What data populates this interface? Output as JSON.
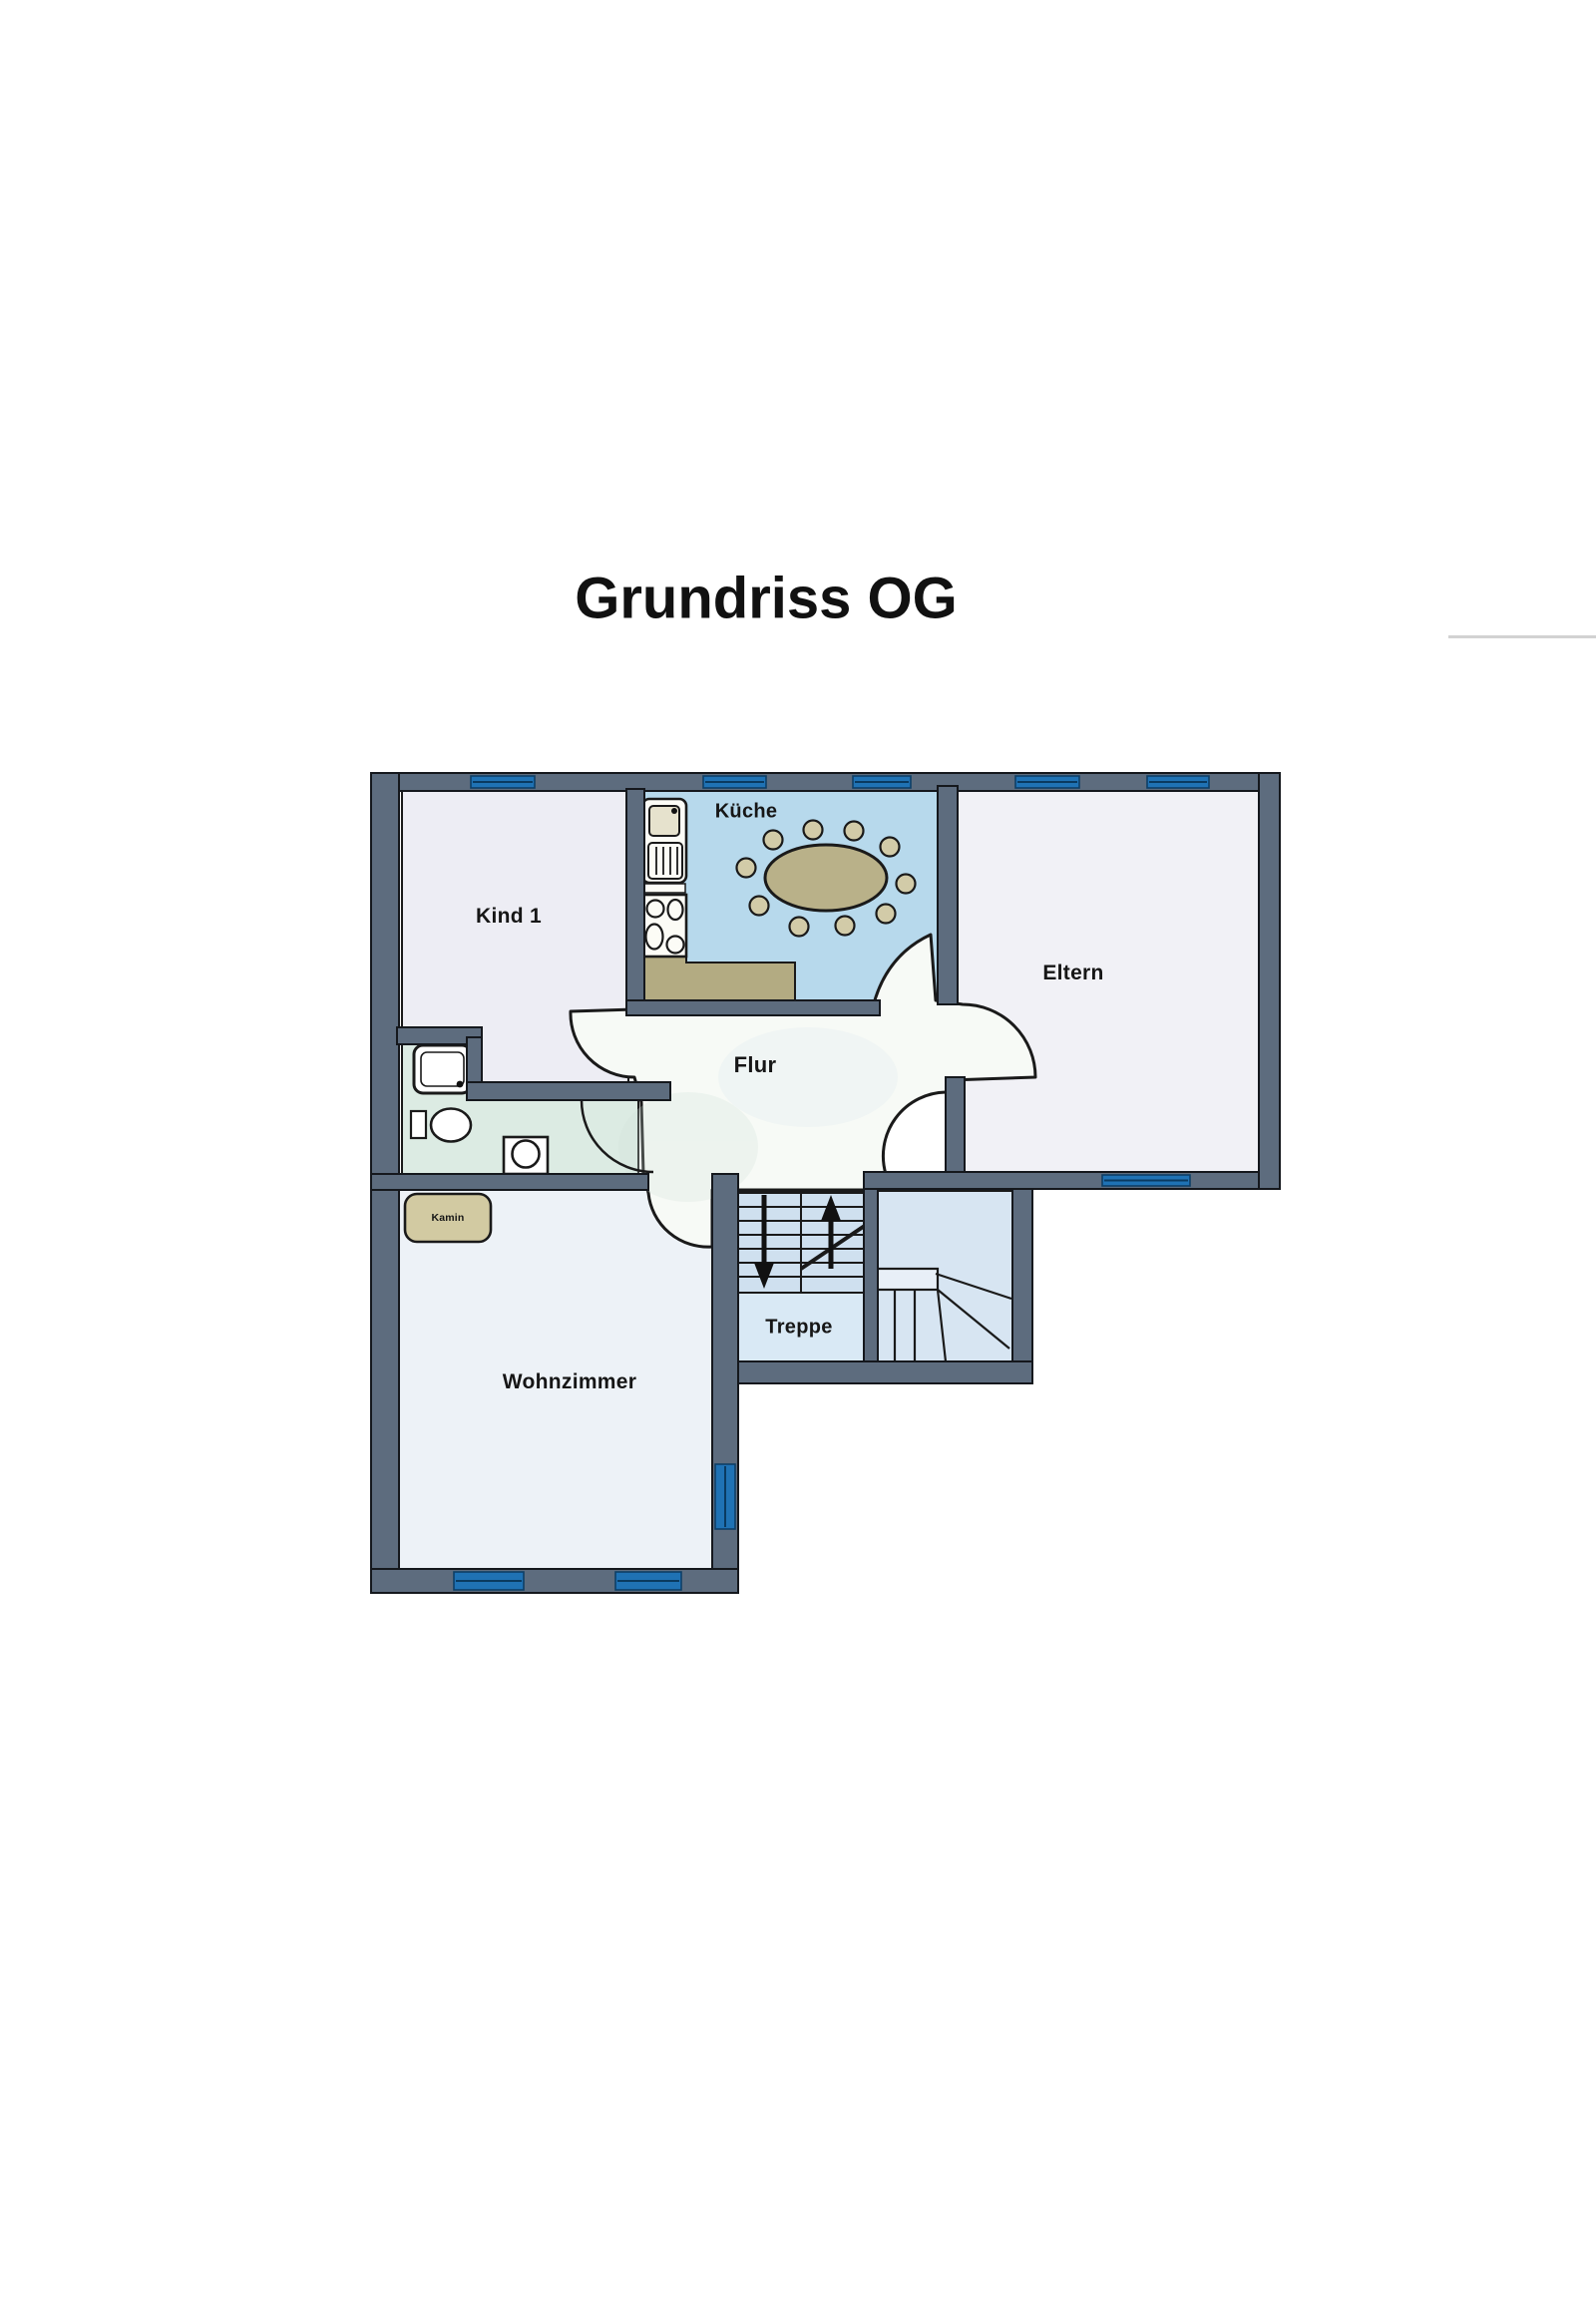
{
  "title": "Grundriss OG",
  "floor_plan": {
    "rooms": {
      "kind1": {
        "label": "Kind 1"
      },
      "kueche": {
        "label": "Küche"
      },
      "eltern": {
        "label": "Eltern"
      },
      "flur": {
        "label": "Flur"
      },
      "treppe": {
        "label": "Treppe"
      },
      "wohnzimmer": {
        "label": "Wohnzimmer"
      },
      "kamin": {
        "label": "Kamin"
      }
    },
    "features": {
      "furniture_icons": [
        "fridge-icon",
        "stove-icon",
        "kitchen-counter",
        "dining-table",
        "chair-x10",
        "shower-icon",
        "toilet-icon",
        "washbasin-icon",
        "fireplace-box",
        "staircase-straight",
        "staircase-winder"
      ],
      "stair_arrows": [
        "up-arrow",
        "down-arrow"
      ],
      "window_counts": {
        "top_wall": 5,
        "eltern_bottom_wall": 1,
        "wohnzimmer_bottom_wall": 2,
        "wohnzimmer_right_wall": 1
      },
      "dining_chairs": 10
    },
    "colors": {
      "wall": "#5d6c7e",
      "window_blue": "#1f72b4",
      "kitchen_floor": "#b7d9ec",
      "bath_floor": "#dcebe3",
      "kind1_floor": "#ededf4",
      "eltern_floor": "#f1f1f6",
      "wohnzimmer_floor": "#edf2f7",
      "flur_floor": "#f7faf6",
      "stairs_floor": "#cfe0ef",
      "furniture_tan": "#b9b189",
      "kamin_tan": "#d2caa2"
    }
  }
}
